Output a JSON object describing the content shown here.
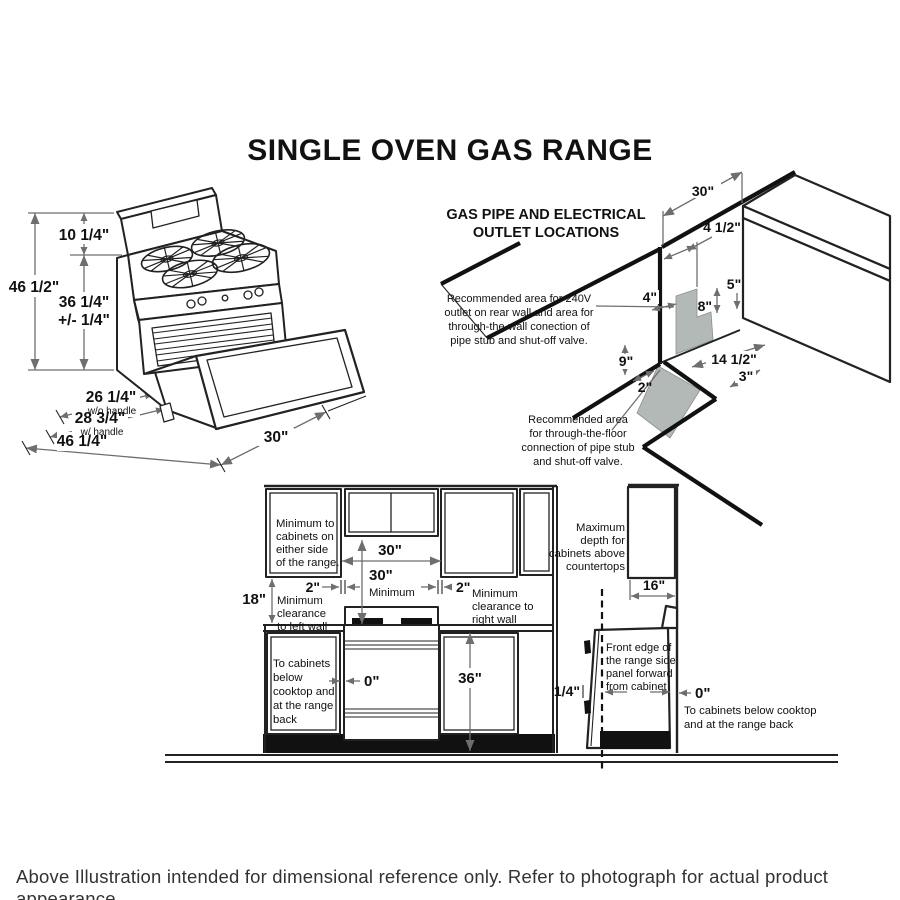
{
  "title": "SINGLE OVEN GAS RANGE",
  "footer": "Above Illustration intended for dimensional reference only. Refer to photograph for actual product appearance.",
  "iso": {
    "h_total": "46 1/2\"",
    "h_backguard": "10 1/4\"",
    "h_cooktop_a": "36 1/4\"",
    "h_cooktop_b": "+/- 1/4\"",
    "d_wo_handle": "26 1/4\"",
    "d_wo_handle_sub": "w/o handle",
    "d_w_handle": "28 3/4\"",
    "d_w_handle_sub": "w/ handle",
    "d_door_open": "46 1/4\"",
    "width": "30\""
  },
  "gas": {
    "heading1": "GAS PIPE AND ELECTRICAL",
    "heading2": "OUTLET LOCATIONS",
    "wall_note": [
      "Recommended area for 240V",
      "outlet on rear wall and area for",
      "through-the-wall conection of",
      "pipe stub and shut-off valve."
    ],
    "floor_note": [
      "Recommended area",
      "for through-the-floor",
      "connection of pipe stub",
      "and shut-off valve."
    ],
    "d30": "30\"",
    "d45": "4 1/2\"",
    "d5": "5\"",
    "d4": "4\"",
    "d8": "8\"",
    "d9": "9\"",
    "d2": "2\"",
    "d145": "14 1/2\"",
    "d3": "3\""
  },
  "front": {
    "side_note": [
      "Minimum to",
      "cabinets on",
      "either side",
      "of the range."
    ],
    "left_wall_note": [
      "Minimum",
      "clearance",
      "to left wall"
    ],
    "right_wall_note": [
      "Minimum",
      "clearance to",
      "right wall"
    ],
    "below_note": [
      "To cabinets",
      "below",
      "cooktop and",
      "at the range",
      "back"
    ],
    "d30_top": "30\"",
    "d30_min": "30\"",
    "d30_min_sub": "Minimum",
    "d2_left": "2\"",
    "d2_right": "2\"",
    "d18": "18\"",
    "d36": "36\"",
    "d0": "0\""
  },
  "side": {
    "max_depth_note": [
      "Maximum",
      "depth for",
      "cabinets above",
      "countertops"
    ],
    "front_edge_note": [
      "Front edge of",
      "the range side",
      "panel forward",
      "from cabinet"
    ],
    "back_note": [
      "To cabinets below cooktop",
      "and at the range back"
    ],
    "d16": "16\"",
    "d14": "1/4\"",
    "d0": "0\""
  }
}
